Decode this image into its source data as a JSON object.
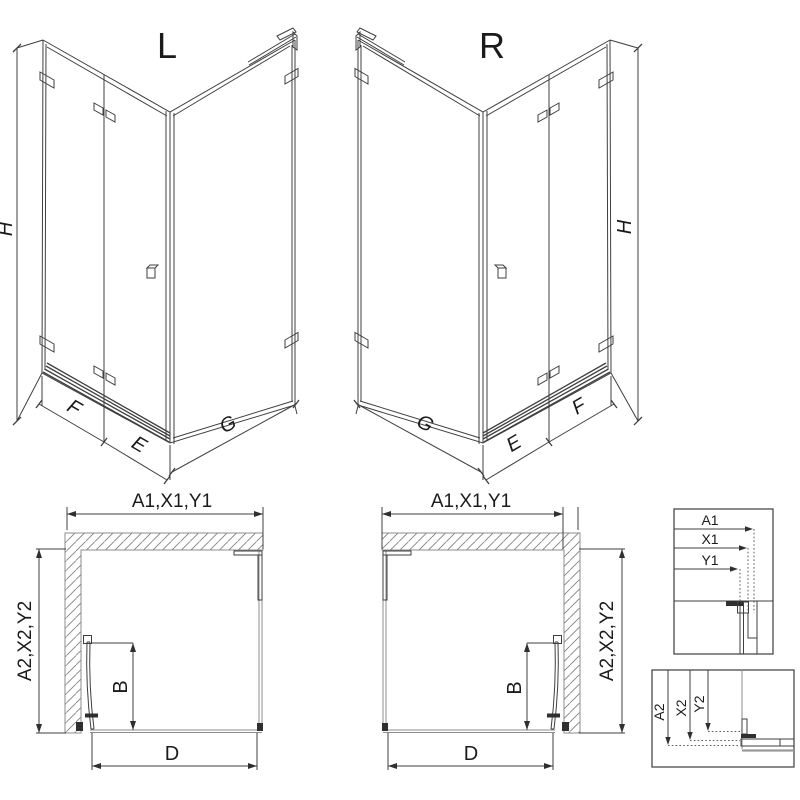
{
  "colors": {
    "background": "#ffffff",
    "line": "#3f3f3f",
    "light_line": "#8c8c8c",
    "dark_fill": "#2f2f2f"
  },
  "iso_left": {
    "label": "L",
    "dim_height": "H",
    "dim_panel": "F",
    "dim_door": "E",
    "dim_side": "G"
  },
  "iso_right": {
    "label": "R",
    "dim_height": "H",
    "dim_panel": "F",
    "dim_door": "E",
    "dim_side": "G"
  },
  "plan_left": {
    "dim_width": "A1,X1,Y1",
    "dim_depth": "A2,X2,Y2",
    "dim_door": "B",
    "dim_bottom": "D"
  },
  "plan_right": {
    "dim_width": "A1,X1,Y1",
    "dim_depth": "A2,X2,Y2",
    "dim_door": "B",
    "dim_bottom": "D"
  },
  "detail_top": {
    "labels": [
      "A1",
      "X1",
      "Y1"
    ]
  },
  "detail_bottom": {
    "labels": [
      "A2",
      "X2",
      "Y2"
    ]
  }
}
